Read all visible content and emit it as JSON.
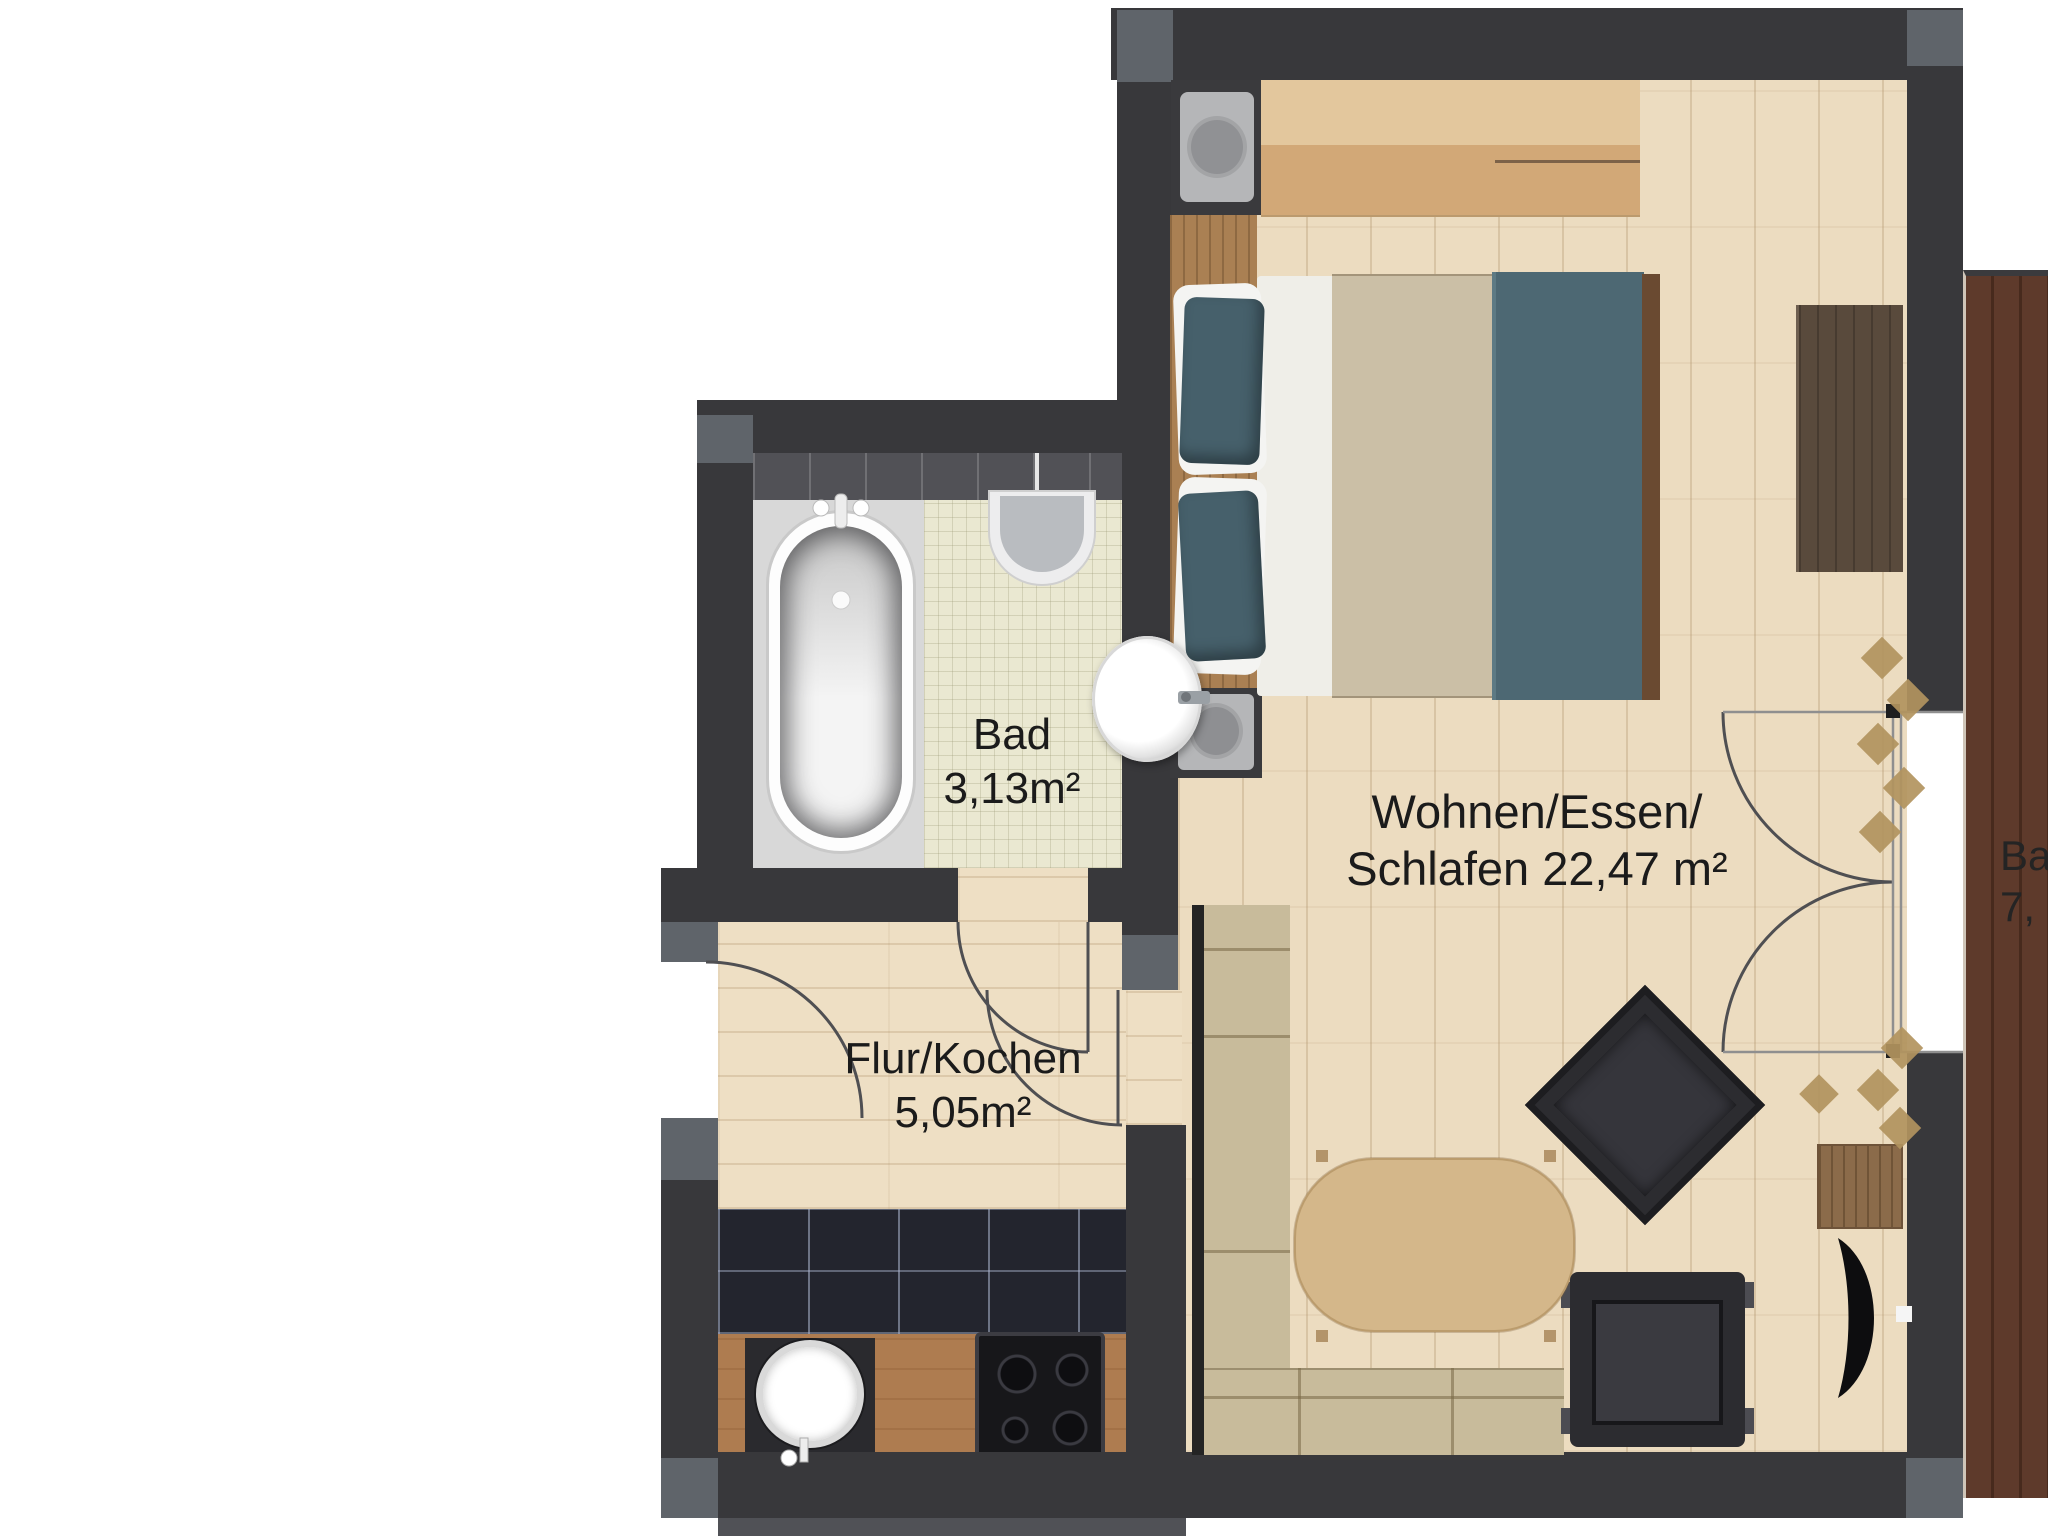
{
  "labels": {
    "bad": {
      "line1": "Bad",
      "line2": "3,13m²"
    },
    "flur": {
      "line1": "Flur/Kochen",
      "line2": "5,05m²"
    },
    "wohnen": {
      "line1": "Wohnen/Essen/",
      "line2": "Schlafen 22,47 m²"
    },
    "balkon": {
      "line1": "Ba",
      "line2": "7,"
    }
  },
  "colors": {
    "wall": "#38383b",
    "wall_accent": "#5f646a",
    "parquet": "#ecdcc0",
    "tile_floor": "#eae8d1",
    "kitchen_tile": "#23252e",
    "counter": "#ae7c50",
    "deck": "#5c392b",
    "bed_teal": "#4d6873",
    "bed_beige": "#cbbfa6",
    "sofa": "#c8bb9b",
    "table": "#d4b78a",
    "chair_dark": "#2c2c30",
    "wood_trim": "#aa8053"
  }
}
